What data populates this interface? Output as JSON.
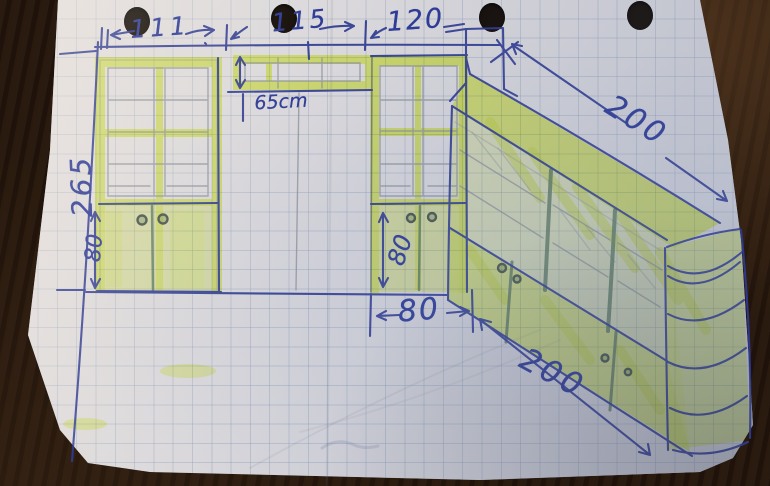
{
  "drawing": {
    "title_hint": "hand-drawn cabinet plan on squared paper",
    "labels": {
      "width_left": "111",
      "width_middle": "115",
      "width_right": "120",
      "shelf_height": "65cm",
      "total_height_left": "265",
      "base_height_left": "80",
      "base_height_middle": "80",
      "base_width_middle": "80",
      "run_length_top": "200",
      "run_length_bottom": "200"
    },
    "colors": {
      "pen_blue": "#2e3a92",
      "pencil_gray": "#8a9098",
      "cabinet_green": "#57755a",
      "highlighter_yellow": "#e8fb62",
      "paper": "#d8d6da",
      "grid_line": "#647ca0",
      "table_wood": "#221509",
      "punch_hole": "#140d08"
    }
  }
}
